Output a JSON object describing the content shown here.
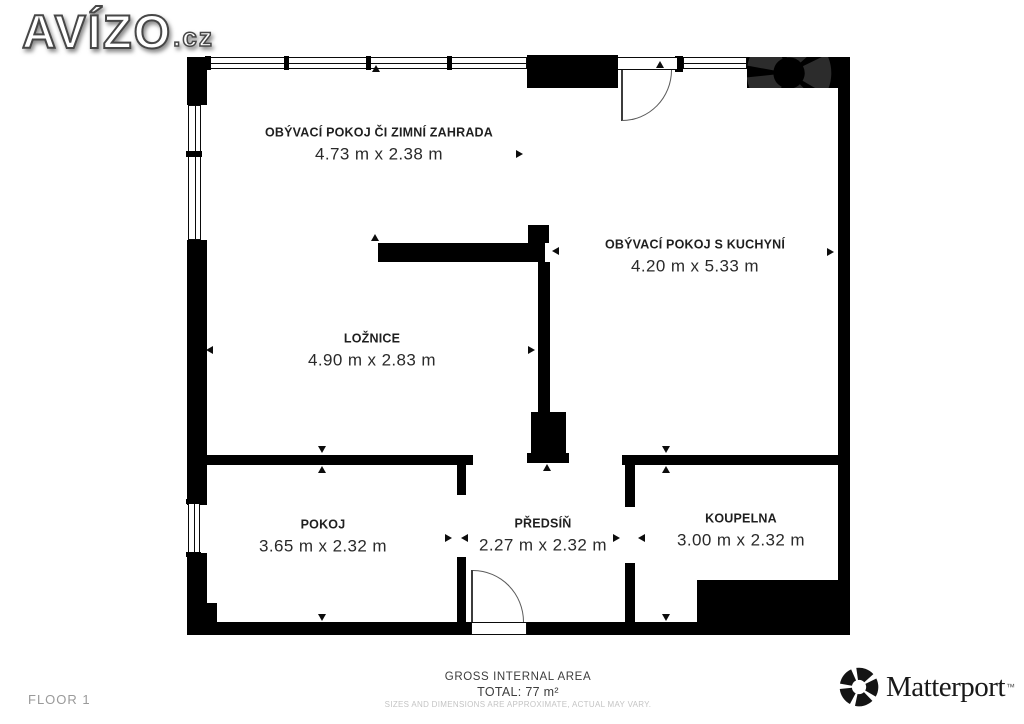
{
  "logo": {
    "brand": "AVÍZO",
    "tld": ".cz"
  },
  "plan": {
    "rooms": [
      {
        "name": "OBÝVACÍ POKOJ ČI ZIMNÍ ZAHRADA",
        "dims": "4.73 m x 2.38 m"
      },
      {
        "name": "OBÝVACÍ POKOJ S KUCHYNÍ",
        "dims": "4.20 m x 5.33 m"
      },
      {
        "name": "LOŽNICE",
        "dims": "4.90 m x 2.83 m"
      },
      {
        "name": "POKOJ",
        "dims": "3.65 m x 2.32 m"
      },
      {
        "name": "PŘEDSÍŇ",
        "dims": "2.27 m x 2.32 m"
      },
      {
        "name": "KOUPELNA",
        "dims": "3.00 m x 2.32 m"
      }
    ]
  },
  "footer": {
    "floor_label": "FLOOR 1",
    "area_title": "GROSS INTERNAL AREA",
    "area_total": "TOTAL: 77 m²",
    "disclaimer": "SIZES AND DIMENSIONS ARE APPROXIMATE, ACTUAL MAY VARY.",
    "matterport_wordmark": "Matterport",
    "matterport_tm": "™"
  },
  "colors": {
    "wall": "#000000",
    "label_text": "#2a2a2a",
    "muted_text": "#9a9a9a",
    "faint_text": "#c4c4c4"
  }
}
